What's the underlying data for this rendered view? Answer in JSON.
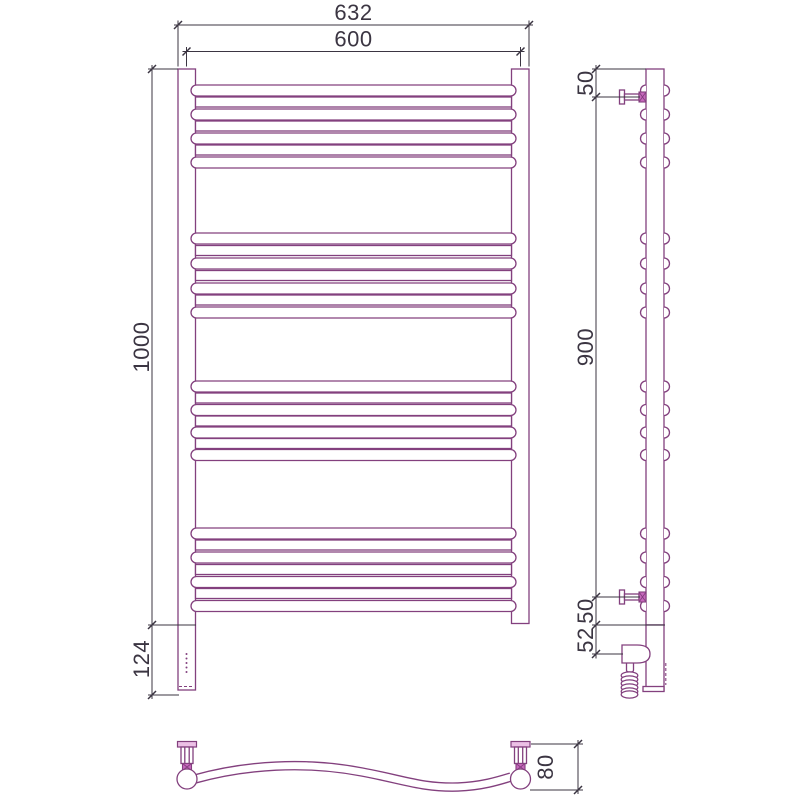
{
  "drawing_type": "technical-orthographic-views-towel-rail",
  "colors": {
    "outline": "#83407e",
    "dimension": "#3b3542",
    "accent_fill": "#c767bd",
    "background": "#ffffff"
  },
  "dimensions": {
    "front_width_overall": "632",
    "front_width_centers": "600",
    "front_height": "1000",
    "front_element_height": "124",
    "side_top_bracket_offset": "50",
    "side_bracket_span": "900",
    "side_bottom_bracket_offset": "50",
    "side_element_axis_offset": "52",
    "bottom_depth": "80"
  },
  "geometry": {
    "front": {
      "post_left_x": 178,
      "post_right_x": 511.5,
      "post_width": 17.5,
      "post_top_y": 69,
      "post_bottom_y": 625,
      "right_post_bottom_y": 623.5,
      "element_bottom_y": 690,
      "stadium_x": 191,
      "stadium_w": 325,
      "stadium_h": 11,
      "plain_x": 195.5,
      "plain_w": 316,
      "plain_h": 10,
      "rung_groups": [
        {
          "stadium_tops": [
            85,
            109,
            133,
            157
          ],
          "plain_tops": [
            97,
            121,
            145
          ]
        },
        {
          "stadium_tops": [
            233,
            258,
            283,
            307
          ],
          "plain_tops": [
            245.5,
            270.5,
            295
          ]
        },
        {
          "stadium_tops": [
            381,
            404.5,
            427,
            449.5
          ],
          "plain_tops": [
            393,
            416,
            438.5
          ]
        },
        {
          "stadium_tops": [
            528,
            552,
            576.5,
            600.5
          ],
          "plain_tops": [
            540,
            564.5,
            588.5
          ]
        }
      ],
      "indicator_dot_ys": [
        654,
        658.5,
        663,
        667.5,
        672
      ]
    },
    "side": {
      "post_left": 646,
      "post_right": 664,
      "post_top_y": 69,
      "post_bottom_y": 625,
      "element_bottom_y": 691,
      "bump_r": 5.5,
      "coil": {
        "cx": 629.5,
        "rx": 8.3,
        "ry": 3.6,
        "cys": [
          675.5,
          679.5,
          683.5,
          687.5,
          691.5,
          694.5
        ]
      }
    },
    "bottom": {
      "left_post_cx": 187,
      "right_post_cx": 520.5,
      "post_cy": 779,
      "post_r": 10
    }
  }
}
